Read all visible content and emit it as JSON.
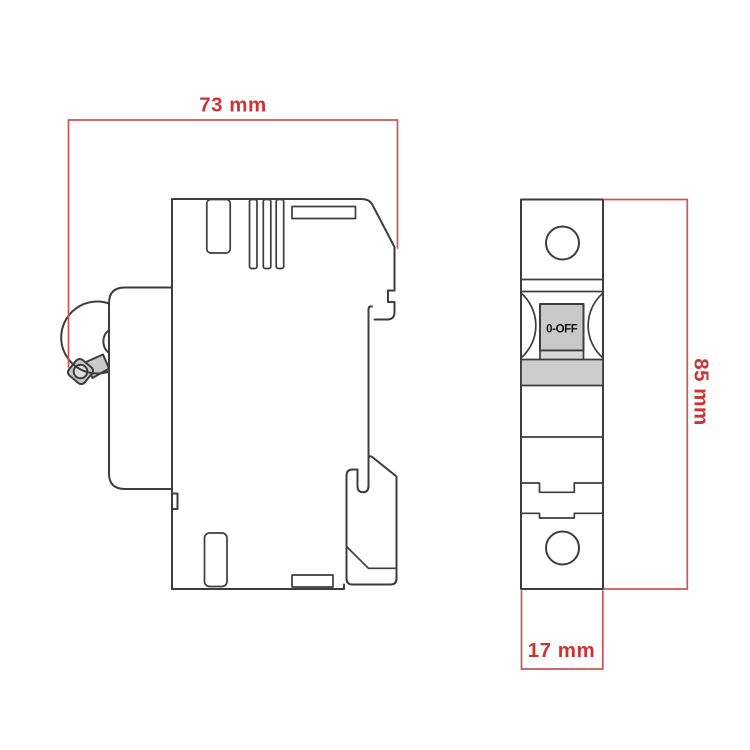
{
  "diagram": {
    "dimensions": {
      "width": {
        "label": "73 mm",
        "value": 73,
        "unit": "mm"
      },
      "height": {
        "label": "85 mm",
        "value": 85,
        "unit": "mm"
      },
      "depth": {
        "label": "17 mm",
        "value": 17,
        "unit": "mm"
      }
    },
    "front_view": {
      "toggle_label": "0-OFF"
    },
    "colors": {
      "background": "#ffffff",
      "outline": "#3d3d3d",
      "dimension_line": "#cd5454",
      "dimension_text": "#cb3434",
      "toggle_fill": "#c9c9c9",
      "toggle_base_fill": "#d8d8d8",
      "band_fill": "#cdcdcd",
      "lever_fill": "#c9c9c9",
      "lever_hole_fill": "#dedede"
    }
  }
}
